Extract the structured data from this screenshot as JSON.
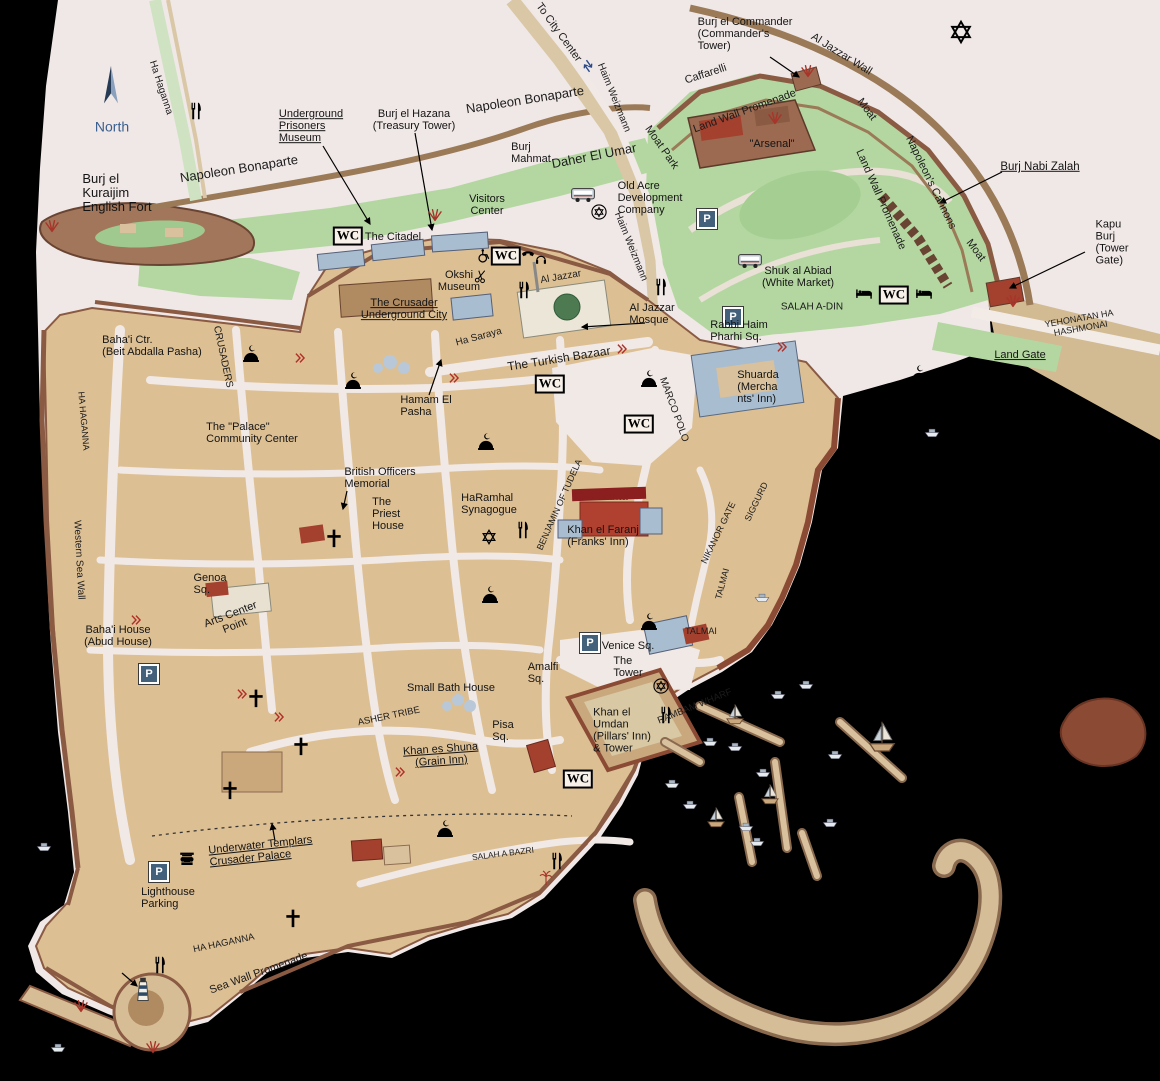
{
  "map": {
    "name": "Old Acre (Akko) illustrated tourist map",
    "compass_label": "North"
  },
  "icon_labels": {
    "wc": "WC",
    "parking": "P"
  },
  "labels": [
    {
      "n": "compass-label",
      "t": "North",
      "x": 112,
      "y": 127,
      "s": 14,
      "c": "#3a5f8f"
    },
    {
      "n": "street-ha-haganna-north",
      "t": "Ha Haganna",
      "x": 160,
      "y": 88,
      "r": 72,
      "s": 10,
      "k": "street"
    },
    {
      "n": "label-burj-el-kuraijim",
      "t": "Burj el\nKuraijim\nEnglish Fort",
      "x": 117,
      "y": 193,
      "s": 13,
      "a": "l"
    },
    {
      "n": "street-napoleon-bonaparte-west",
      "t": "Napoleon Bonaparte",
      "x": 239,
      "y": 169,
      "r": -9,
      "s": 13,
      "k": "street"
    },
    {
      "n": "street-napoleon-bonaparte-center",
      "t": "Napoleon Bonaparte",
      "x": 525,
      "y": 100,
      "r": -9,
      "s": 13,
      "k": "street"
    },
    {
      "n": "street-to-city-center",
      "t": "To City Center",
      "x": 558,
      "y": 33,
      "r": 54,
      "s": 11,
      "k": "street"
    },
    {
      "n": "street-haim-weizmann-north",
      "t": "Haim Weizmann",
      "x": 613,
      "y": 98,
      "r": 68,
      "s": 10,
      "k": "street"
    },
    {
      "n": "label-underground-prisoners-museum",
      "t": "Underground\nPrisoners\nMuseum",
      "x": 311,
      "y": 127,
      "s": 11,
      "k": "link",
      "a": "l"
    },
    {
      "n": "label-burj-el-hazana",
      "t": "Burj el Hazana\n(Treasury Tower)",
      "x": 414,
      "y": 121,
      "s": 11
    },
    {
      "n": "label-burj-mahmat",
      "t": "Burj\nMahmat",
      "x": 531,
      "y": 154,
      "s": 11,
      "a": "l"
    },
    {
      "n": "street-daher-el-umar",
      "t": "Daher El Umar",
      "x": 594,
      "y": 156,
      "r": -11,
      "s": 13,
      "k": "street"
    },
    {
      "n": "street-moat-park",
      "t": "Moat Park",
      "x": 661,
      "y": 148,
      "r": 55,
      "s": 11,
      "k": "street"
    },
    {
      "n": "street-caffarelli",
      "t": "Caffarelli",
      "x": 706,
      "y": 75,
      "r": -18,
      "s": 11,
      "k": "street"
    },
    {
      "n": "label-burj-el-commander",
      "t": "Burj el Commander\n(Commander's\nTower)",
      "x": 745,
      "y": 35,
      "s": 11,
      "a": "l"
    },
    {
      "n": "street-al-jazzar-wall",
      "t": "Al Jazzar Wall",
      "x": 841,
      "y": 55,
      "r": 32,
      "s": 11,
      "k": "street"
    },
    {
      "n": "street-land-wall-promenade-north",
      "t": "Land Wall Promenade",
      "x": 745,
      "y": 112,
      "r": -20,
      "s": 11,
      "k": "street"
    },
    {
      "n": "street-moat-north",
      "t": "Moat",
      "x": 866,
      "y": 110,
      "r": 53,
      "s": 11,
      "k": "street"
    },
    {
      "n": "label-arsenal",
      "t": "\"Arsenal\"",
      "x": 772,
      "y": 145,
      "s": 11
    },
    {
      "n": "street-napoleons-cannons",
      "t": "Napoleon's Cannons",
      "x": 930,
      "y": 183,
      "r": 64,
      "s": 11,
      "k": "street"
    },
    {
      "n": "street-land-wall-promenade-east",
      "t": "Land Wall Promenade",
      "x": 880,
      "y": 200,
      "r": 66,
      "s": 11,
      "k": "street"
    },
    {
      "n": "street-moat-east",
      "t": "Moat",
      "x": 975,
      "y": 251,
      "r": 53,
      "s": 11,
      "k": "street"
    },
    {
      "n": "label-burj-nabi-zalah",
      "t": "Burj Nabi Zalah",
      "x": 1040,
      "y": 167,
      "s": 11.5,
      "k": "link"
    },
    {
      "n": "label-kapu-burj",
      "t": "Kapu Burj\n(Tower Gate)",
      "x": 1117,
      "y": 243,
      "s": 11,
      "a": "l"
    },
    {
      "n": "label-old-acre-development",
      "t": "Old Acre\nDevelopment\nCompany",
      "x": 650,
      "y": 199,
      "s": 11,
      "a": "l"
    },
    {
      "n": "label-visitors-center",
      "t": "Visitors\nCenter",
      "x": 487,
      "y": 206,
      "s": 11
    },
    {
      "n": "label-the-citadel",
      "t": "The Citadel",
      "x": 393,
      "y": 238,
      "s": 11
    },
    {
      "n": "label-okshi-museum",
      "t": "Okshi\nMuseum",
      "x": 459,
      "y": 282,
      "s": 11
    },
    {
      "n": "label-crusader-underground-city",
      "t": "The Crusader\nUnderground City",
      "x": 404,
      "y": 310,
      "s": 11,
      "k": "link"
    },
    {
      "n": "street-haim-weizmann-mid",
      "t": "Haim Weizmann",
      "x": 630,
      "y": 247,
      "r": 68,
      "s": 10,
      "k": "street"
    },
    {
      "n": "label-shuk-al-abiad",
      "t": "Shuk al Abiad\n(White Market)",
      "x": 798,
      "y": 278,
      "s": 11
    },
    {
      "n": "street-salah-a-din",
      "t": "SALAH A-DIN",
      "x": 812,
      "y": 308,
      "s": 10,
      "k": "street"
    },
    {
      "n": "street-al-jazzar",
      "t": "Al Jazzar",
      "x": 561,
      "y": 278,
      "r": -10,
      "s": 10,
      "k": "street"
    },
    {
      "n": "label-al-jazzar-mosque",
      "t": "Al Jazzar\nMosque",
      "x": 652,
      "y": 315,
      "s": 11,
      "a": "l"
    },
    {
      "n": "label-rabbi-haim-pharhi-sq",
      "t": "Rabbi Haim\nPharhi Sq.",
      "x": 739,
      "y": 332,
      "s": 11,
      "a": "l"
    },
    {
      "n": "street-yehonatan-ha-hashmonai",
      "t": "YEHONATAN HA HASHMONAI",
      "x": 1080,
      "y": 324,
      "r": -10,
      "s": 9,
      "k": "street"
    },
    {
      "n": "label-land-gate",
      "t": "Land Gate",
      "x": 1020,
      "y": 356,
      "s": 11,
      "k": "link"
    },
    {
      "n": "label-bahai-ctr",
      "t": "Baha'i Ctr.\n(Beit Abdalla Pasha)",
      "x": 152,
      "y": 347,
      "s": 11,
      "a": "l"
    },
    {
      "n": "street-crusaders",
      "t": "CRUSADERS",
      "x": 222,
      "y": 357,
      "r": 78,
      "s": 10,
      "k": "street"
    },
    {
      "n": "street-ha-saraya",
      "t": "Ha Saraya",
      "x": 479,
      "y": 338,
      "r": -15,
      "s": 10,
      "k": "street"
    },
    {
      "n": "street-turkish-bazaar",
      "t": "The Turkish Bazaar",
      "x": 559,
      "y": 359,
      "r": -9,
      "s": 12,
      "k": "street"
    },
    {
      "n": "label-hamam-el-pasha",
      "t": "Hamam El\nPasha",
      "x": 426,
      "y": 407,
      "s": 11,
      "a": "l"
    },
    {
      "n": "label-shuarda",
      "t": "Shuarda\n(Mercha\nnts' Inn)",
      "x": 758,
      "y": 388,
      "s": 11,
      "a": "l"
    },
    {
      "n": "street-marco-polo",
      "t": "MARCO POLO",
      "x": 673,
      "y": 410,
      "r": 70,
      "s": 10,
      "k": "street"
    },
    {
      "n": "label-palace-community-center",
      "t": "The \"Palace\"\nCommunity Center",
      "x": 252,
      "y": 434,
      "s": 11,
      "a": "l"
    },
    {
      "n": "label-british-officers-memorial",
      "t": "British Officers\nMemorial",
      "x": 380,
      "y": 479,
      "s": 11,
      "a": "l"
    },
    {
      "n": "label-priest-house",
      "t": "The\nPriest\nHouse",
      "x": 388,
      "y": 515,
      "s": 11,
      "a": "l"
    },
    {
      "n": "label-haramhal-synagogue",
      "t": "HaRamhal\nSynagogue",
      "x": 489,
      "y": 505,
      "s": 11,
      "a": "l"
    },
    {
      "n": "street-benjamin-of-tudela",
      "t": "BENJAMIN OF TUDELA",
      "x": 560,
      "y": 505,
      "r": -66,
      "s": 9,
      "k": "street"
    },
    {
      "n": "label-tara-santa",
      "t": "Tara Santa",
      "x": 600,
      "y": 497,
      "s": 11.5,
      "c": "#8b1f1f"
    },
    {
      "n": "label-khan-el-faranj",
      "t": "Khan el Faranj\n(Franks' Inn)",
      "x": 603,
      "y": 537,
      "s": 11,
      "a": "l"
    },
    {
      "n": "street-nikanor-gate",
      "t": "NIKANOR GATE",
      "x": 719,
      "y": 533,
      "r": -64,
      "s": 9,
      "k": "street"
    },
    {
      "n": "street-siggurd",
      "t": "SIGGURD",
      "x": 757,
      "y": 502,
      "r": -64,
      "s": 9,
      "k": "street"
    },
    {
      "n": "street-talmai-vertical",
      "t": "TALMAI",
      "x": 723,
      "y": 584,
      "r": -75,
      "s": 9,
      "k": "street"
    },
    {
      "n": "street-talmai",
      "t": "TALMAI",
      "x": 701,
      "y": 632,
      "s": 9,
      "k": "street"
    },
    {
      "n": "label-genoa-sq",
      "t": "Genoa\nSq.",
      "x": 210,
      "y": 585,
      "s": 11,
      "a": "l"
    },
    {
      "n": "label-arts-center-point",
      "t": "Arts Center\nPoint",
      "x": 233,
      "y": 621,
      "r": -21,
      "s": 11
    },
    {
      "n": "label-bahai-house",
      "t": "Baha'i House\n(Abud House)",
      "x": 118,
      "y": 637,
      "s": 11
    },
    {
      "n": "street-western-sea-wall",
      "t": "Western Sea Wall",
      "x": 78,
      "y": 560,
      "r": 87,
      "s": 10,
      "k": "street"
    },
    {
      "n": "street-ha-haganna-west",
      "t": "HA HAGANNA",
      "x": 83,
      "y": 421,
      "r": 85,
      "s": 9,
      "k": "street"
    },
    {
      "n": "label-amalfi-sq",
      "t": "Amalfi\nSq.",
      "x": 543,
      "y": 674,
      "s": 11,
      "a": "l"
    },
    {
      "n": "label-small-bath-house",
      "t": "Small Bath House",
      "x": 451,
      "y": 689,
      "s": 11
    },
    {
      "n": "street-asher-tribe",
      "t": "ASHER TRIBE",
      "x": 389,
      "y": 717,
      "r": -12,
      "s": 9.5,
      "k": "street"
    },
    {
      "n": "label-pisa-sq",
      "t": "Pisa\nSq.",
      "x": 503,
      "y": 732,
      "s": 11,
      "a": "l"
    },
    {
      "n": "label-khan-es-shuna",
      "t": "Khan es Shuna\n(Grain Inn)",
      "x": 441,
      "y": 756,
      "r": -4,
      "s": 11,
      "k": "link"
    },
    {
      "n": "label-venice-sq",
      "t": "Venice Sq.",
      "x": 628,
      "y": 647,
      "s": 11
    },
    {
      "n": "label-the-tower",
      "t": "The\nTower",
      "x": 628,
      "y": 668,
      "s": 11,
      "a": "l"
    },
    {
      "n": "label-khan-el-umdan",
      "t": "Khan el\nUmdan\n(Pillars' Inn)\n& Tower",
      "x": 622,
      "y": 731,
      "s": 11,
      "a": "l"
    },
    {
      "n": "street-rambam-wharf",
      "t": "RAMBAM WHARF",
      "x": 695,
      "y": 707,
      "r": -22,
      "s": 9.5,
      "k": "street"
    },
    {
      "n": "street-salah-a-bazri",
      "t": "SALAH A BAZRI",
      "x": 503,
      "y": 854,
      "r": -7,
      "s": 8.5,
      "k": "street"
    },
    {
      "n": "label-underwater-templars",
      "t": "Underwater Templars\nCrusader Palace",
      "x": 261,
      "y": 852,
      "r": -6,
      "s": 11,
      "k": "link",
      "a": "l"
    },
    {
      "n": "label-lighthouse-parking",
      "t": "Lighthouse\nParking",
      "x": 168,
      "y": 899,
      "s": 11,
      "a": "l"
    },
    {
      "n": "street-ha-haganna-south",
      "t": "HA HAGANNA",
      "x": 224,
      "y": 944,
      "r": -12,
      "s": 9.5,
      "k": "street"
    },
    {
      "n": "street-sea-wall-promenade",
      "t": "Sea Wall Promenade",
      "x": 259,
      "y": 974,
      "r": -20,
      "s": 11,
      "k": "street"
    }
  ],
  "icons": [
    {
      "t": "compass",
      "x": 111,
      "y": 85
    },
    {
      "t": "arrowsBlue",
      "x": 588,
      "y": 66,
      "r": 54
    },
    {
      "t": "wc",
      "x": 348,
      "y": 236
    },
    {
      "t": "wc",
      "x": 506,
      "y": 256
    },
    {
      "t": "wc",
      "x": 894,
      "y": 295
    },
    {
      "t": "wc",
      "x": 550,
      "y": 384
    },
    {
      "t": "wc",
      "x": 639,
      "y": 424
    },
    {
      "t": "wc",
      "x": 578,
      "y": 779
    },
    {
      "t": "parking",
      "x": 707,
      "y": 219
    },
    {
      "t": "parking",
      "x": 733,
      "y": 317
    },
    {
      "t": "parking",
      "x": 149,
      "y": 674
    },
    {
      "t": "parking",
      "x": 590,
      "y": 643
    },
    {
      "t": "parking",
      "x": 159,
      "y": 872
    },
    {
      "t": "fork",
      "x": 196,
      "y": 111
    },
    {
      "t": "fork",
      "x": 524,
      "y": 290
    },
    {
      "t": "fork",
      "x": 661,
      "y": 287
    },
    {
      "t": "fork",
      "x": 523,
      "y": 530
    },
    {
      "t": "fork",
      "x": 666,
      "y": 715
    },
    {
      "t": "fork",
      "x": 160,
      "y": 965
    },
    {
      "t": "fork",
      "x": 557,
      "y": 861
    },
    {
      "t": "bed",
      "x": 864,
      "y": 293
    },
    {
      "t": "bed",
      "x": 924,
      "y": 293
    },
    {
      "t": "bus",
      "x": 583,
      "y": 194
    },
    {
      "t": "bus",
      "x": 750,
      "y": 260
    },
    {
      "t": "dome",
      "x": 353,
      "y": 382
    },
    {
      "t": "dome",
      "x": 251,
      "y": 355
    },
    {
      "t": "dome",
      "x": 486,
      "y": 443
    },
    {
      "t": "dome",
      "x": 649,
      "y": 380
    },
    {
      "t": "dome",
      "x": 919,
      "y": 375
    },
    {
      "t": "dome",
      "x": 490,
      "y": 596
    },
    {
      "t": "dome",
      "x": 649,
      "y": 623
    },
    {
      "t": "dome",
      "x": 445,
      "y": 830
    },
    {
      "t": "cross",
      "x": 334,
      "y": 538
    },
    {
      "t": "cross",
      "x": 256,
      "y": 698
    },
    {
      "t": "cross",
      "x": 301,
      "y": 746
    },
    {
      "t": "cross",
      "x": 230,
      "y": 790
    },
    {
      "t": "cross",
      "x": 293,
      "y": 918
    },
    {
      "t": "star6",
      "x": 961,
      "y": 32,
      "s": 1.5
    },
    {
      "t": "star6",
      "x": 489,
      "y": 537
    },
    {
      "t": "starCircle",
      "x": 599,
      "y": 212
    },
    {
      "t": "starCircle",
      "x": 661,
      "y": 686
    },
    {
      "t": "wheelchair",
      "x": 484,
      "y": 256
    },
    {
      "t": "phone",
      "x": 528,
      "y": 256
    },
    {
      "t": "headphones",
      "x": 541,
      "y": 259
    },
    {
      "t": "scissors",
      "x": 481,
      "y": 276
    },
    {
      "t": "umbrella",
      "x": 927,
      "y": 380
    },
    {
      "t": "column",
      "x": 187,
      "y": 859
    },
    {
      "t": "lighthouse",
      "x": 143,
      "y": 990
    },
    {
      "t": "palm",
      "x": 546,
      "y": 878
    },
    {
      "t": "chev",
      "x": 300,
      "y": 358
    },
    {
      "t": "chev",
      "x": 454,
      "y": 378
    },
    {
      "t": "chev",
      "x": 622,
      "y": 349
    },
    {
      "t": "chev",
      "x": 782,
      "y": 347
    },
    {
      "t": "chev",
      "x": 136,
      "y": 620
    },
    {
      "t": "chev",
      "x": 242,
      "y": 694
    },
    {
      "t": "chev",
      "x": 279,
      "y": 717
    },
    {
      "t": "chev",
      "x": 400,
      "y": 772
    },
    {
      "t": "fan",
      "x": 52,
      "y": 225
    },
    {
      "t": "fan",
      "x": 808,
      "y": 70
    },
    {
      "t": "fan",
      "x": 775,
      "y": 117
    },
    {
      "t": "fan",
      "x": 435,
      "y": 214
    },
    {
      "t": "fan",
      "x": 1013,
      "y": 300
    },
    {
      "t": "fan",
      "x": 81,
      "y": 1005
    },
    {
      "t": "fan",
      "x": 153,
      "y": 1046
    },
    {
      "t": "sailboat",
      "x": 735,
      "y": 715
    },
    {
      "t": "sailboat",
      "x": 882,
      "y": 738,
      "s": 1.5
    },
    {
      "t": "sailboat",
      "x": 770,
      "y": 795
    },
    {
      "t": "sailboat",
      "x": 716,
      "y": 818
    },
    {
      "t": "boat",
      "x": 806,
      "y": 683
    },
    {
      "t": "boat",
      "x": 778,
      "y": 693
    },
    {
      "t": "boat",
      "x": 710,
      "y": 740
    },
    {
      "t": "boat",
      "x": 735,
      "y": 745
    },
    {
      "t": "boat",
      "x": 835,
      "y": 753
    },
    {
      "t": "boat",
      "x": 763,
      "y": 771
    },
    {
      "t": "boat",
      "x": 746,
      "y": 825
    },
    {
      "t": "boat",
      "x": 757,
      "y": 840
    },
    {
      "t": "boat",
      "x": 830,
      "y": 821
    },
    {
      "t": "boat",
      "x": 672,
      "y": 782
    },
    {
      "t": "boat",
      "x": 690,
      "y": 803
    },
    {
      "t": "boat",
      "x": 932,
      "y": 431
    },
    {
      "t": "boat",
      "x": 762,
      "y": 596
    },
    {
      "t": "boat",
      "x": 44,
      "y": 845
    },
    {
      "t": "boat",
      "x": 58,
      "y": 1046
    }
  ]
}
